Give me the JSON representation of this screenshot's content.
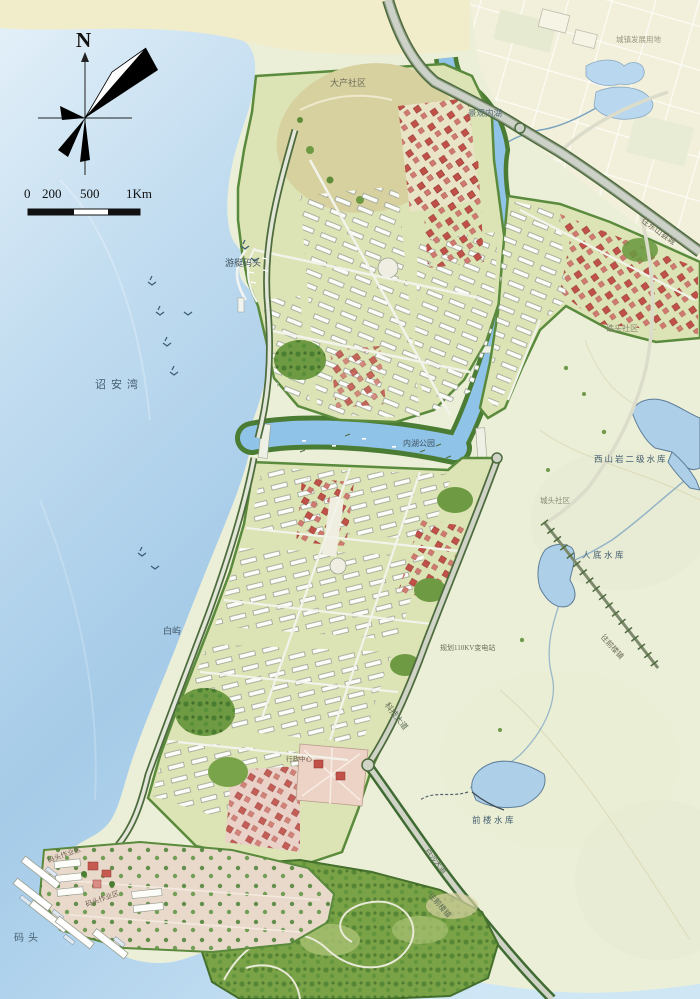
{
  "map": {
    "compass": {
      "north": "N"
    },
    "scale": {
      "ticks": [
        "0",
        "200",
        "500",
        "1Km"
      ]
    },
    "labels": {
      "dachan": "大产社区",
      "jingguan_neihu": "景观内湖",
      "dev_land": "城镇发展用地",
      "wang_dongshan": "往东山县城",
      "jiaotou": "礁头社区",
      "zhaoan_bay": "诏安湾",
      "youting_matou": "游艇码头",
      "neihu_gongyuan": "内湖公园",
      "xishanyan": "西山岩二级水库",
      "chengtou": "城头社区",
      "rendi": "人底水库",
      "baiyu": "白屿",
      "substation": "规划110KV变电站",
      "keji_dadao": "科技大道",
      "wang_qianlou_ne": "往前楼镇",
      "qianlou_reservoir": "前楼水库",
      "baisha_dadao": "白沙大道",
      "wang_qianlou_s": "往前楼镇",
      "xingzheng": "行政中心",
      "matou": "码头",
      "zuoye_1": "码头作业区",
      "zuoye_2": "码头作业区"
    },
    "palette": {
      "sea": "#a5cbe8",
      "land_pale": "#ecefd8",
      "district_green": "#dce3b4",
      "park_green": "#7aa247",
      "tree_green": "#39702a",
      "road_gray": "#cdd2c8",
      "building_white": "#fcfcf8",
      "building_red": "#c05048",
      "inner_water": "#8fc3e8",
      "pavement_pink": "#e9d9cb"
    }
  }
}
